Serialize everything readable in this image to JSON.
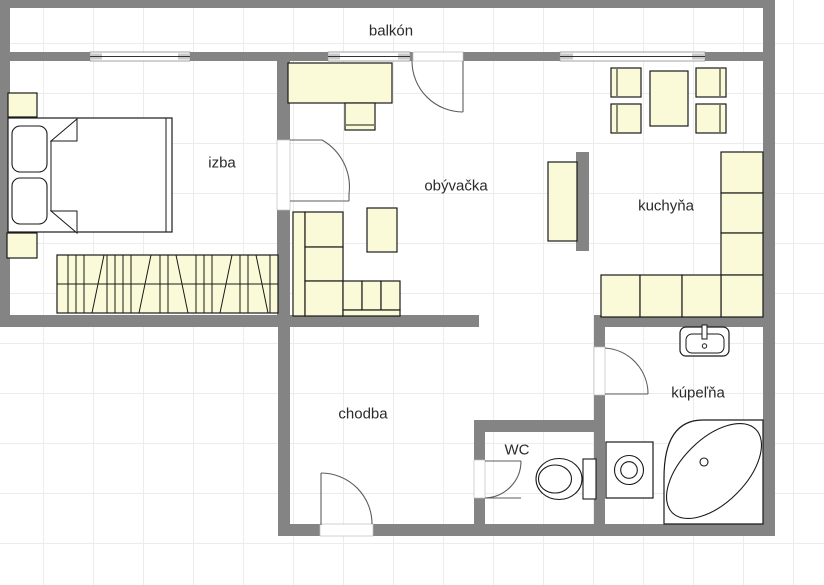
{
  "rooms": {
    "balcony": {
      "label": "balkón"
    },
    "bedroom": {
      "label": "izba"
    },
    "living_room": {
      "label": "obývačka"
    },
    "kitchen": {
      "label": "kuchyňa"
    },
    "hallway": {
      "label": "chodba"
    },
    "wc": {
      "label": "WC"
    },
    "bathroom": {
      "label": "kúpeľňa"
    }
  },
  "colors": {
    "wall": "#848484",
    "furniture_fill": "#FBFAD8",
    "fixture_fill": "#FFFFFF",
    "outline": "#1A1A1A",
    "door_arc": "#5E5E5E",
    "window_cap": "#C9C9C9",
    "grid_line": "#ECECEC",
    "label_text": "#2A2A2A",
    "background": "#FFFFFF"
  },
  "icons": {
    "bedroom": [
      "bed-icon",
      "pillow-icon",
      "nightstand-icon",
      "wardrobe-icon"
    ],
    "living_room": [
      "desk-icon",
      "desk-chair-icon",
      "corner-sofa-icon",
      "armchair-icon",
      "tv-cabinet-icon"
    ],
    "kitchen": [
      "dining-table-icon",
      "dining-chair-icon",
      "kitchen-counter-icon"
    ],
    "bathroom": [
      "washbasin-icon",
      "washing-machine-icon",
      "corner-bathtub-icon"
    ],
    "wc": [
      "toilet-icon"
    ],
    "openings": [
      "window-icon",
      "door-swing-icon"
    ]
  }
}
